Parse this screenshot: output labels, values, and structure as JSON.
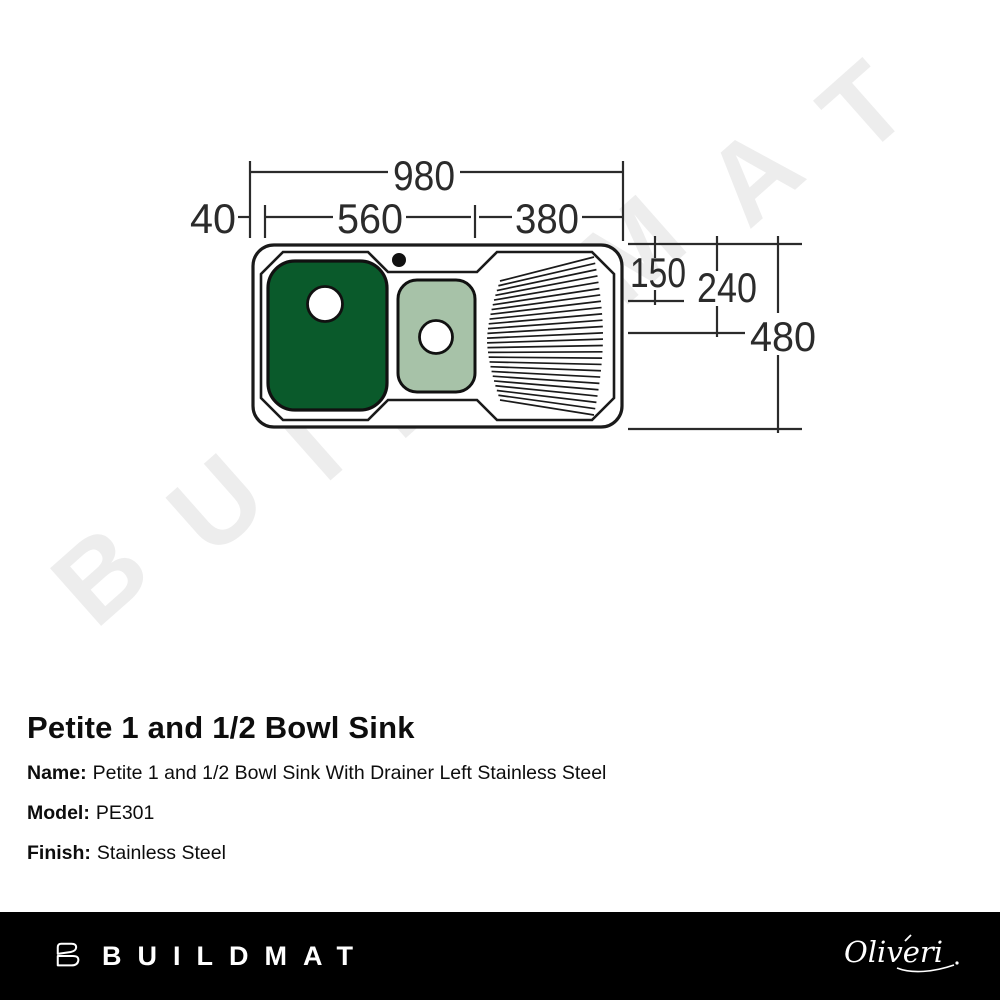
{
  "watermark": {
    "text": "BUILDMAT"
  },
  "diagram": {
    "dims": {
      "overall_width": "980",
      "left_edge_offset": "40",
      "bowl_section_width": "560",
      "drainer_width": "380",
      "rim_to_ledge_depth": "150",
      "small_bowl_depth": "240",
      "overall_depth": "480"
    },
    "colors": {
      "large_bowl": "#0a5a2b",
      "small_bowl": "#a7c2a8",
      "line": "#1a1a1a"
    }
  },
  "product": {
    "title": "Petite 1 and 1/2 Bowl Sink",
    "fields": [
      {
        "label": "Name:",
        "value": "Petite 1 and 1/2 Bowl Sink With Drainer Left Stainless Steel"
      },
      {
        "label": "Model:",
        "value": "PE301"
      },
      {
        "label": "Finish:",
        "value": "Stainless Steel"
      }
    ]
  },
  "footer": {
    "brand": "BUILDMAT",
    "partner_logo_text": "Oliveri",
    "background": "#000000"
  }
}
